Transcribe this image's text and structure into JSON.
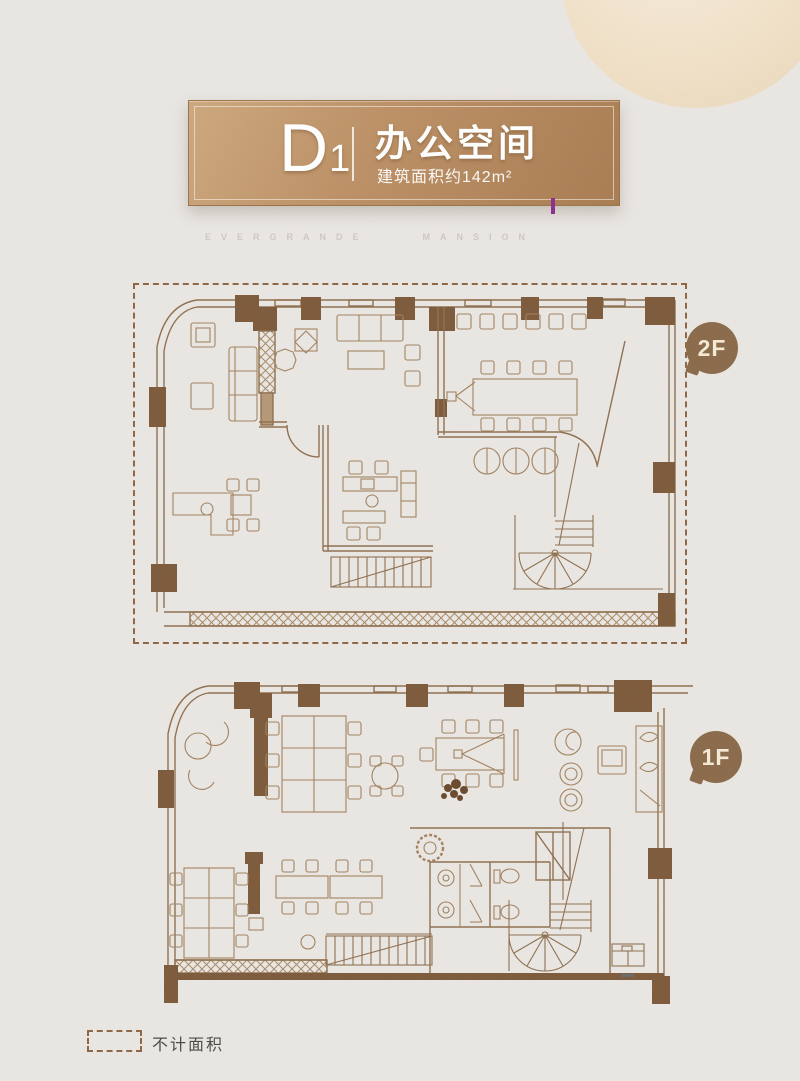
{
  "page": {
    "background": "#eae7e3"
  },
  "plaque": {
    "unit": "D",
    "unit_sub": "1",
    "title": "办公空间",
    "subtitle": "建筑面积约142m²",
    "bronze_from": "#cda87d",
    "bronze_to": "#a87c51"
  },
  "watermark": {
    "left": "EVERGRANDE",
    "right": "MANSION"
  },
  "floors": {
    "f2": {
      "label": "2F",
      "dashed_outline": true
    },
    "f1": {
      "label": "1F"
    }
  },
  "legend": {
    "label": "不计面积"
  },
  "colors": {
    "plan_line": "#8f7050",
    "plan_wall": "#7d5a3b",
    "furniture_line": "#a1825f",
    "dashed_border": "#8d6644",
    "bubble": "#8a6a4a",
    "bubble_text": "#f4e9d5",
    "accent_pink": "#e93f8f",
    "accent_orange": "#f59b3c",
    "accent_purple": "#8b2f8d",
    "accent_red": "#c9245e"
  }
}
